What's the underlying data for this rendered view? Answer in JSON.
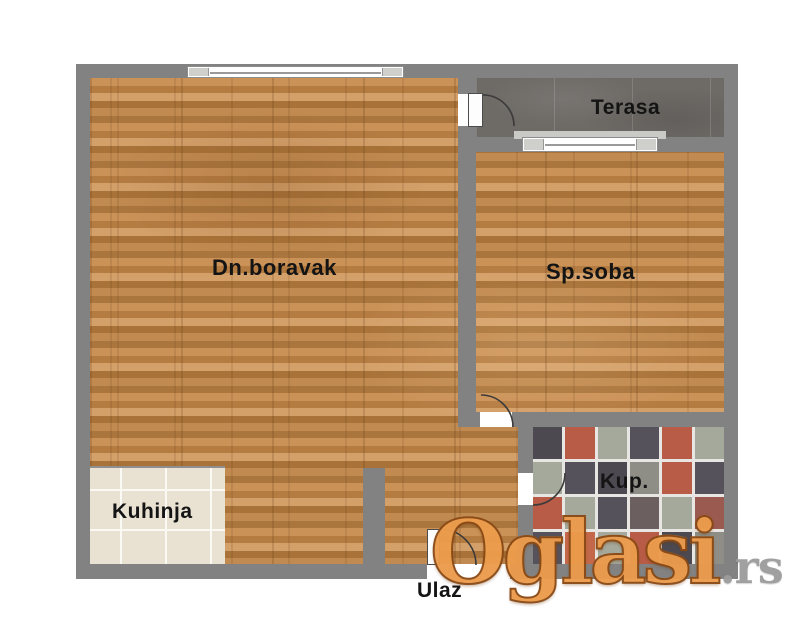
{
  "floorplan": {
    "rooms": {
      "living_room": {
        "label": "Dn.boravak"
      },
      "bedroom": {
        "label": "Sp.soba"
      },
      "terrace": {
        "label": "Terasa"
      },
      "kitchen": {
        "label": "Kuhinja"
      },
      "bathroom": {
        "label": "Kup."
      },
      "entrance": {
        "label": "Ulaz"
      }
    },
    "colors": {
      "wall": "#828282",
      "wood_floor": "#bd8148",
      "terrace_tile": "#6e6a66",
      "kitchen_tile": "#e9e2d2",
      "bathroom_grout": "#e8e6e2"
    },
    "bathroom_tiles": {
      "palette": [
        "#56525b",
        "#b85c47",
        "#a4a99c",
        "#4c4951",
        "#9b5a50",
        "#8e8e86",
        "#6b5f60",
        "#c4684a"
      ],
      "grid": [
        [
          3,
          1,
          2,
          0,
          1,
          2
        ],
        [
          2,
          0,
          3,
          5,
          1,
          0
        ],
        [
          1,
          2,
          0,
          6,
          2,
          4
        ],
        [
          0,
          7,
          2,
          1,
          3,
          5
        ]
      ]
    }
  },
  "watermark": {
    "brand": "Oglasi",
    "suffix": ".rs"
  }
}
